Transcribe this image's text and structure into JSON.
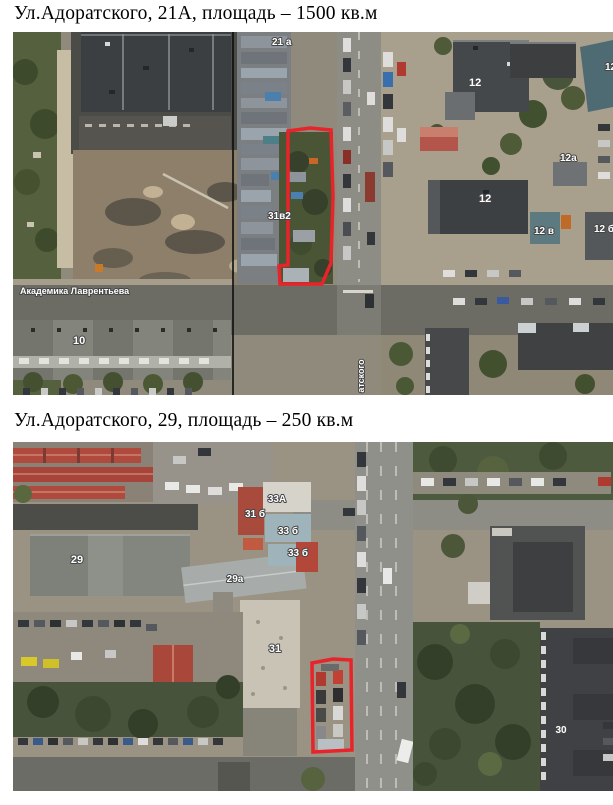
{
  "page": {
    "background": "#ffffff",
    "text_color": "#000000"
  },
  "sections": [
    {
      "caption": "Ул.Адоратского, 21А, площадь – 1500 кв.м",
      "map": {
        "highlight_color": "#e8232a",
        "boundary_line_color": "#000000",
        "street_labels": {
          "lavrentyeva": "Академика Лаврентьева",
          "adoratskogo": "атского"
        },
        "building_labels": {
          "b21a": "21 а",
          "b31v2": "31в2",
          "b12_top": "12",
          "b12_right": "12",
          "b12_mid": "12",
          "b12a": "12а",
          "b12v": "12 в",
          "b12b": "12 б",
          "b10": "10"
        }
      }
    },
    {
      "caption": "Ул.Адоратского, 29, площадь – 250 кв.м",
      "map": {
        "highlight_color": "#e8232a",
        "building_labels": {
          "b33a": "33А",
          "b31b": "31 б",
          "b33b": "33 б",
          "b33b2": "33 б",
          "b29": "29",
          "b29a": "29а",
          "b31": "31",
          "b30": "30"
        }
      }
    }
  ]
}
